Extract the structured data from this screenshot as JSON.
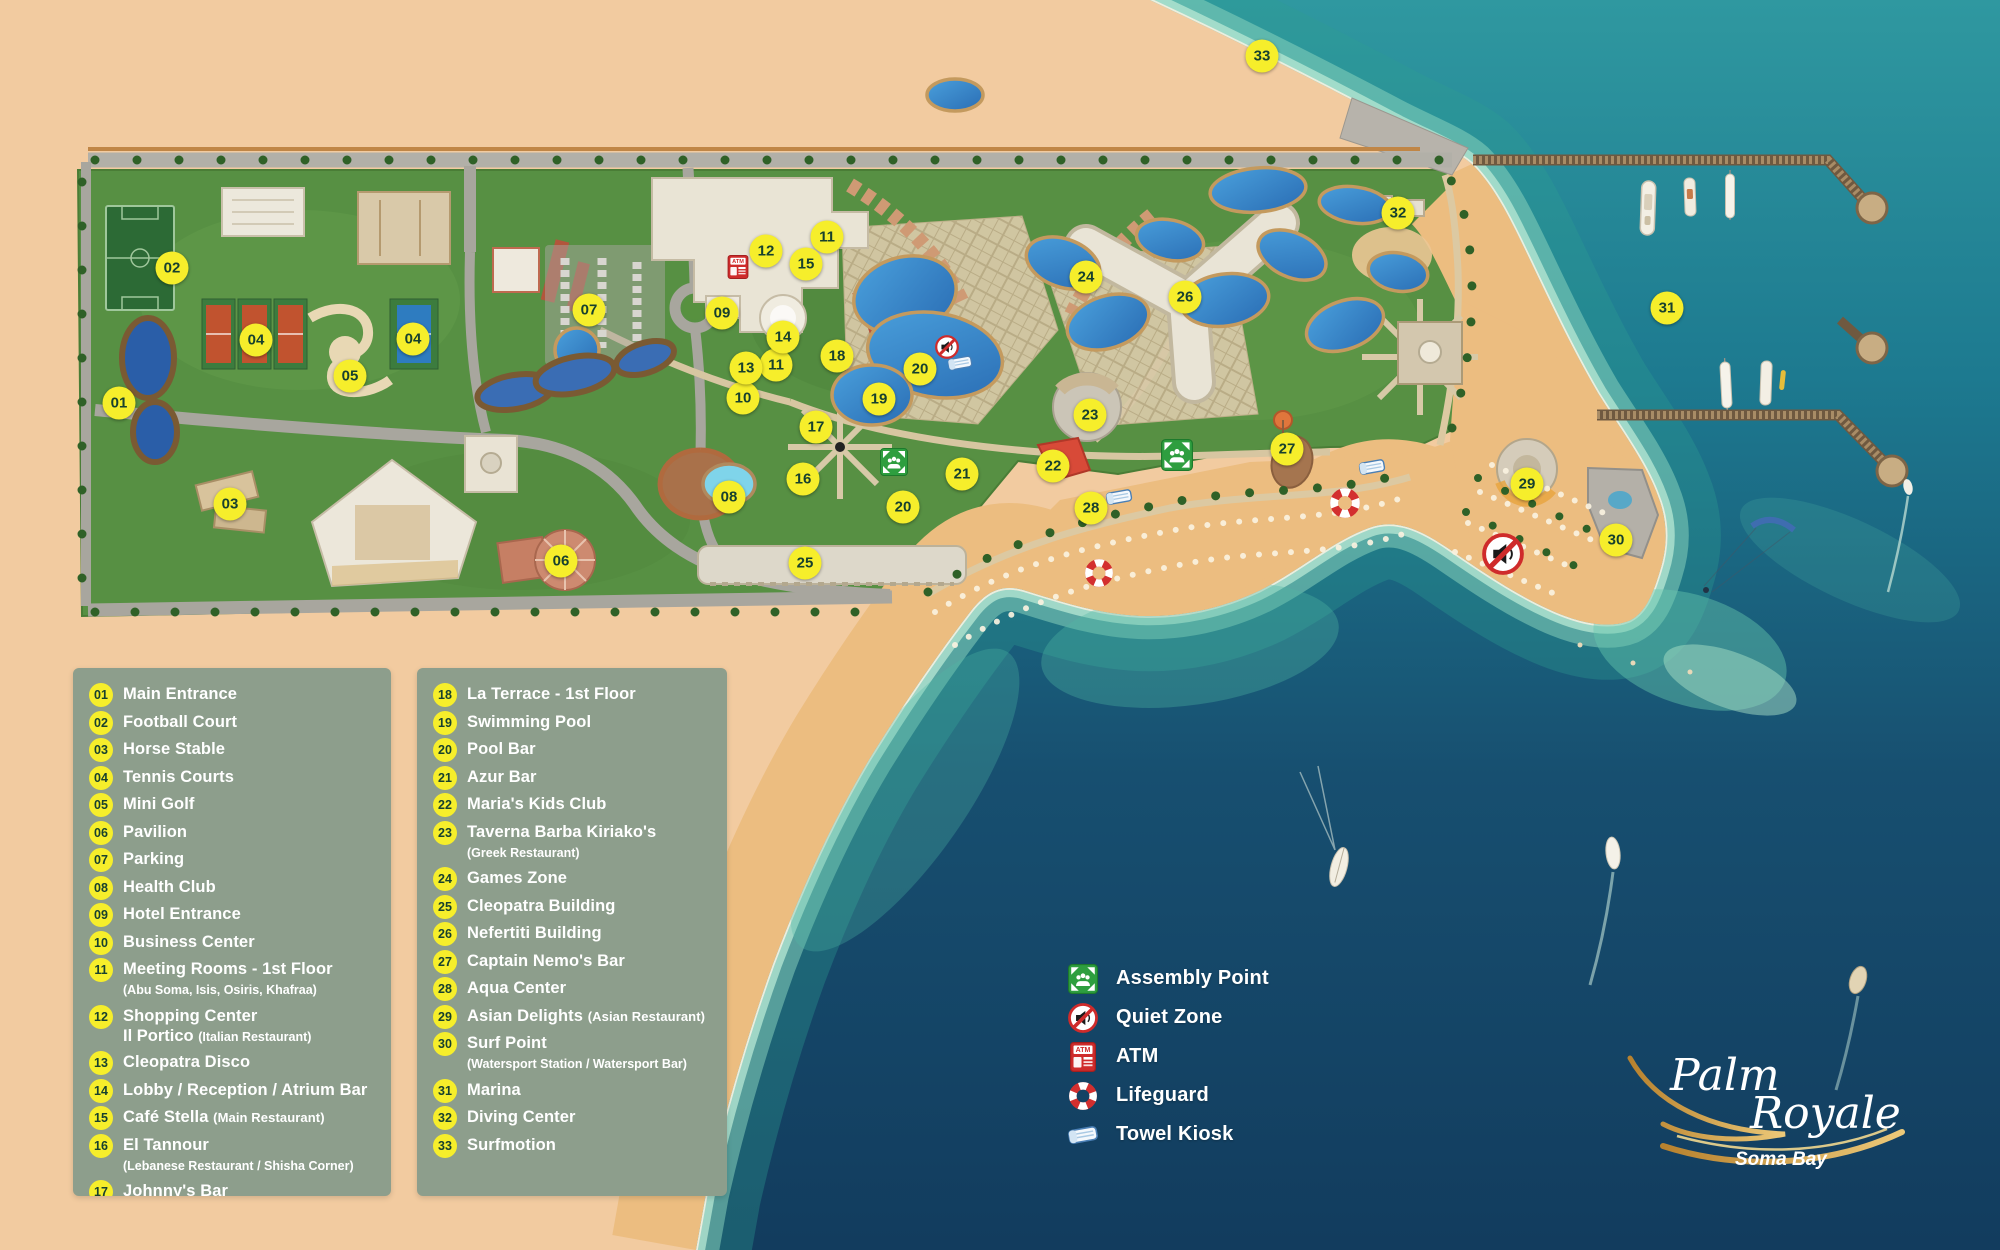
{
  "colors": {
    "marker_yellow": "#f6ee2b",
    "marker_text": "#17402e",
    "panel_bg": "#8d9e8c",
    "sand": "#f2cba0",
    "beach_gold": "#ecbd80",
    "resort_green": "#579043",
    "ocean_shallow": "#5fc0ae",
    "ocean_deep": "#123c5e",
    "pool_blue": "#3b8fd0",
    "atm_red": "#cf2b2b",
    "assembly_green": "#2e9e3f"
  },
  "legend_panels": [
    {
      "items": [
        {
          "num": "01",
          "title": "Main Entrance"
        },
        {
          "num": "02",
          "title": "Football Court"
        },
        {
          "num": "03",
          "title": "Horse Stable"
        },
        {
          "num": "04",
          "title": "Tennis Courts"
        },
        {
          "num": "05",
          "title": "Mini Golf"
        },
        {
          "num": "06",
          "title": "Pavilion"
        },
        {
          "num": "07",
          "title": "Parking"
        },
        {
          "num": "08",
          "title": "Health Club"
        },
        {
          "num": "09",
          "title": "Hotel Entrance"
        },
        {
          "num": "10",
          "title": "Business Center"
        },
        {
          "num": "11",
          "title": "Meeting Rooms - 1st Floor",
          "note2": "(Abu Soma, Isis, Osiris, Khafraa)"
        },
        {
          "num": "12",
          "title": "Shopping Center",
          "title2": "Il Portico",
          "note2": "(Italian Restaurant)"
        },
        {
          "num": "13",
          "title": "Cleopatra Disco"
        },
        {
          "num": "14",
          "title": "Lobby / Reception / Atrium Bar"
        },
        {
          "num": "15",
          "title": "Café Stella",
          "note": "(Main Restaurant)"
        },
        {
          "num": "16",
          "title": "El Tannour",
          "note2": "(Lebanese Restaurant / Shisha Corner)"
        },
        {
          "num": "17",
          "title": "Johnny's Bar"
        }
      ]
    },
    {
      "items": [
        {
          "num": "18",
          "title": "La Terrace - 1st Floor"
        },
        {
          "num": "19",
          "title": "Swimming Pool"
        },
        {
          "num": "20",
          "title": "Pool Bar"
        },
        {
          "num": "21",
          "title": "Azur Bar"
        },
        {
          "num": "22",
          "title": "Maria's Kids Club"
        },
        {
          "num": "23",
          "title": "Taverna Barba Kiriako's",
          "note2": "(Greek Restaurant)"
        },
        {
          "num": "24",
          "title": "Games Zone"
        },
        {
          "num": "25",
          "title": "Cleopatra Building"
        },
        {
          "num": "26",
          "title": "Nefertiti Building"
        },
        {
          "num": "27",
          "title": "Captain Nemo's Bar"
        },
        {
          "num": "28",
          "title": "Aqua Center"
        },
        {
          "num": "29",
          "title": "Asian Delights",
          "note": "(Asian Restaurant)"
        },
        {
          "num": "30",
          "title": "Surf Point",
          "note2": "(Watersport Station / Watersport Bar)"
        },
        {
          "num": "31",
          "title": "Marina"
        },
        {
          "num": "32",
          "title": "Diving Center"
        },
        {
          "num": "33",
          "title": "Surfmotion"
        }
      ]
    }
  ],
  "symbols_legend": {
    "items": [
      {
        "icon": "assembly-point-icon",
        "label": "Assembly Point"
      },
      {
        "icon": "quiet-zone-icon",
        "label": "Quiet Zone"
      },
      {
        "icon": "atm-icon",
        "label": "ATM"
      },
      {
        "icon": "lifeguard-icon",
        "label": "Lifeguard"
      },
      {
        "icon": "towel-kiosk-icon",
        "label": "Towel Kiosk"
      }
    ]
  },
  "logo": {
    "name_line1": "Palm",
    "name_line2": "Royale",
    "subtitle": "Soma Bay"
  },
  "map": {
    "markers": [
      {
        "n": "01",
        "x": 119,
        "y": 403
      },
      {
        "n": "02",
        "x": 172,
        "y": 268
      },
      {
        "n": "03",
        "x": 230,
        "y": 504
      },
      {
        "n": "04",
        "x": 256,
        "y": 340
      },
      {
        "n": "04",
        "x": 413,
        "y": 339
      },
      {
        "n": "05",
        "x": 350,
        "y": 376
      },
      {
        "n": "06",
        "x": 561,
        "y": 561
      },
      {
        "n": "07",
        "x": 589,
        "y": 310
      },
      {
        "n": "08",
        "x": 729,
        "y": 497
      },
      {
        "n": "09",
        "x": 722,
        "y": 313
      },
      {
        "n": "10",
        "x": 743,
        "y": 398
      },
      {
        "n": "11",
        "x": 827,
        "y": 237
      },
      {
        "n": "11",
        "x": 776,
        "y": 365
      },
      {
        "n": "12",
        "x": 766,
        "y": 251
      },
      {
        "n": "13",
        "x": 746,
        "y": 368
      },
      {
        "n": "14",
        "x": 783,
        "y": 337
      },
      {
        "n": "15",
        "x": 806,
        "y": 264
      },
      {
        "n": "16",
        "x": 803,
        "y": 479
      },
      {
        "n": "17",
        "x": 816,
        "y": 427
      },
      {
        "n": "18",
        "x": 837,
        "y": 356
      },
      {
        "n": "19",
        "x": 879,
        "y": 399
      },
      {
        "n": "20",
        "x": 920,
        "y": 369
      },
      {
        "n": "20",
        "x": 903,
        "y": 507
      },
      {
        "n": "21",
        "x": 962,
        "y": 474
      },
      {
        "n": "22",
        "x": 1053,
        "y": 466
      },
      {
        "n": "23",
        "x": 1090,
        "y": 415
      },
      {
        "n": "24",
        "x": 1086,
        "y": 277
      },
      {
        "n": "25",
        "x": 805,
        "y": 563
      },
      {
        "n": "26",
        "x": 1185,
        "y": 297
      },
      {
        "n": "27",
        "x": 1287,
        "y": 449
      },
      {
        "n": "28",
        "x": 1091,
        "y": 508
      },
      {
        "n": "29",
        "x": 1527,
        "y": 484
      },
      {
        "n": "30",
        "x": 1616,
        "y": 540
      },
      {
        "n": "31",
        "x": 1667,
        "y": 308
      },
      {
        "n": "32",
        "x": 1398,
        "y": 213
      },
      {
        "n": "33",
        "x": 1262,
        "y": 56
      }
    ],
    "icons": [
      {
        "type": "atm-icon",
        "x": 738,
        "y": 267,
        "s": 24
      },
      {
        "type": "quiet-zone-icon",
        "x": 947,
        "y": 347,
        "s": 24
      },
      {
        "type": "quiet-zone-icon",
        "x": 1503,
        "y": 554,
        "s": 42
      },
      {
        "type": "assembly-point-icon",
        "x": 894,
        "y": 462,
        "s": 28
      },
      {
        "type": "assembly-point-icon",
        "x": 1177,
        "y": 455,
        "s": 32
      },
      {
        "type": "lifeguard-icon",
        "x": 1099,
        "y": 573,
        "s": 30
      },
      {
        "type": "lifeguard-icon",
        "x": 1345,
        "y": 503,
        "s": 32
      },
      {
        "type": "towel-kiosk-icon",
        "x": 960,
        "y": 363,
        "s": 28
      },
      {
        "type": "towel-kiosk-icon",
        "x": 1119,
        "y": 497,
        "s": 30
      },
      {
        "type": "towel-kiosk-icon",
        "x": 1372,
        "y": 467,
        "s": 30
      }
    ]
  }
}
